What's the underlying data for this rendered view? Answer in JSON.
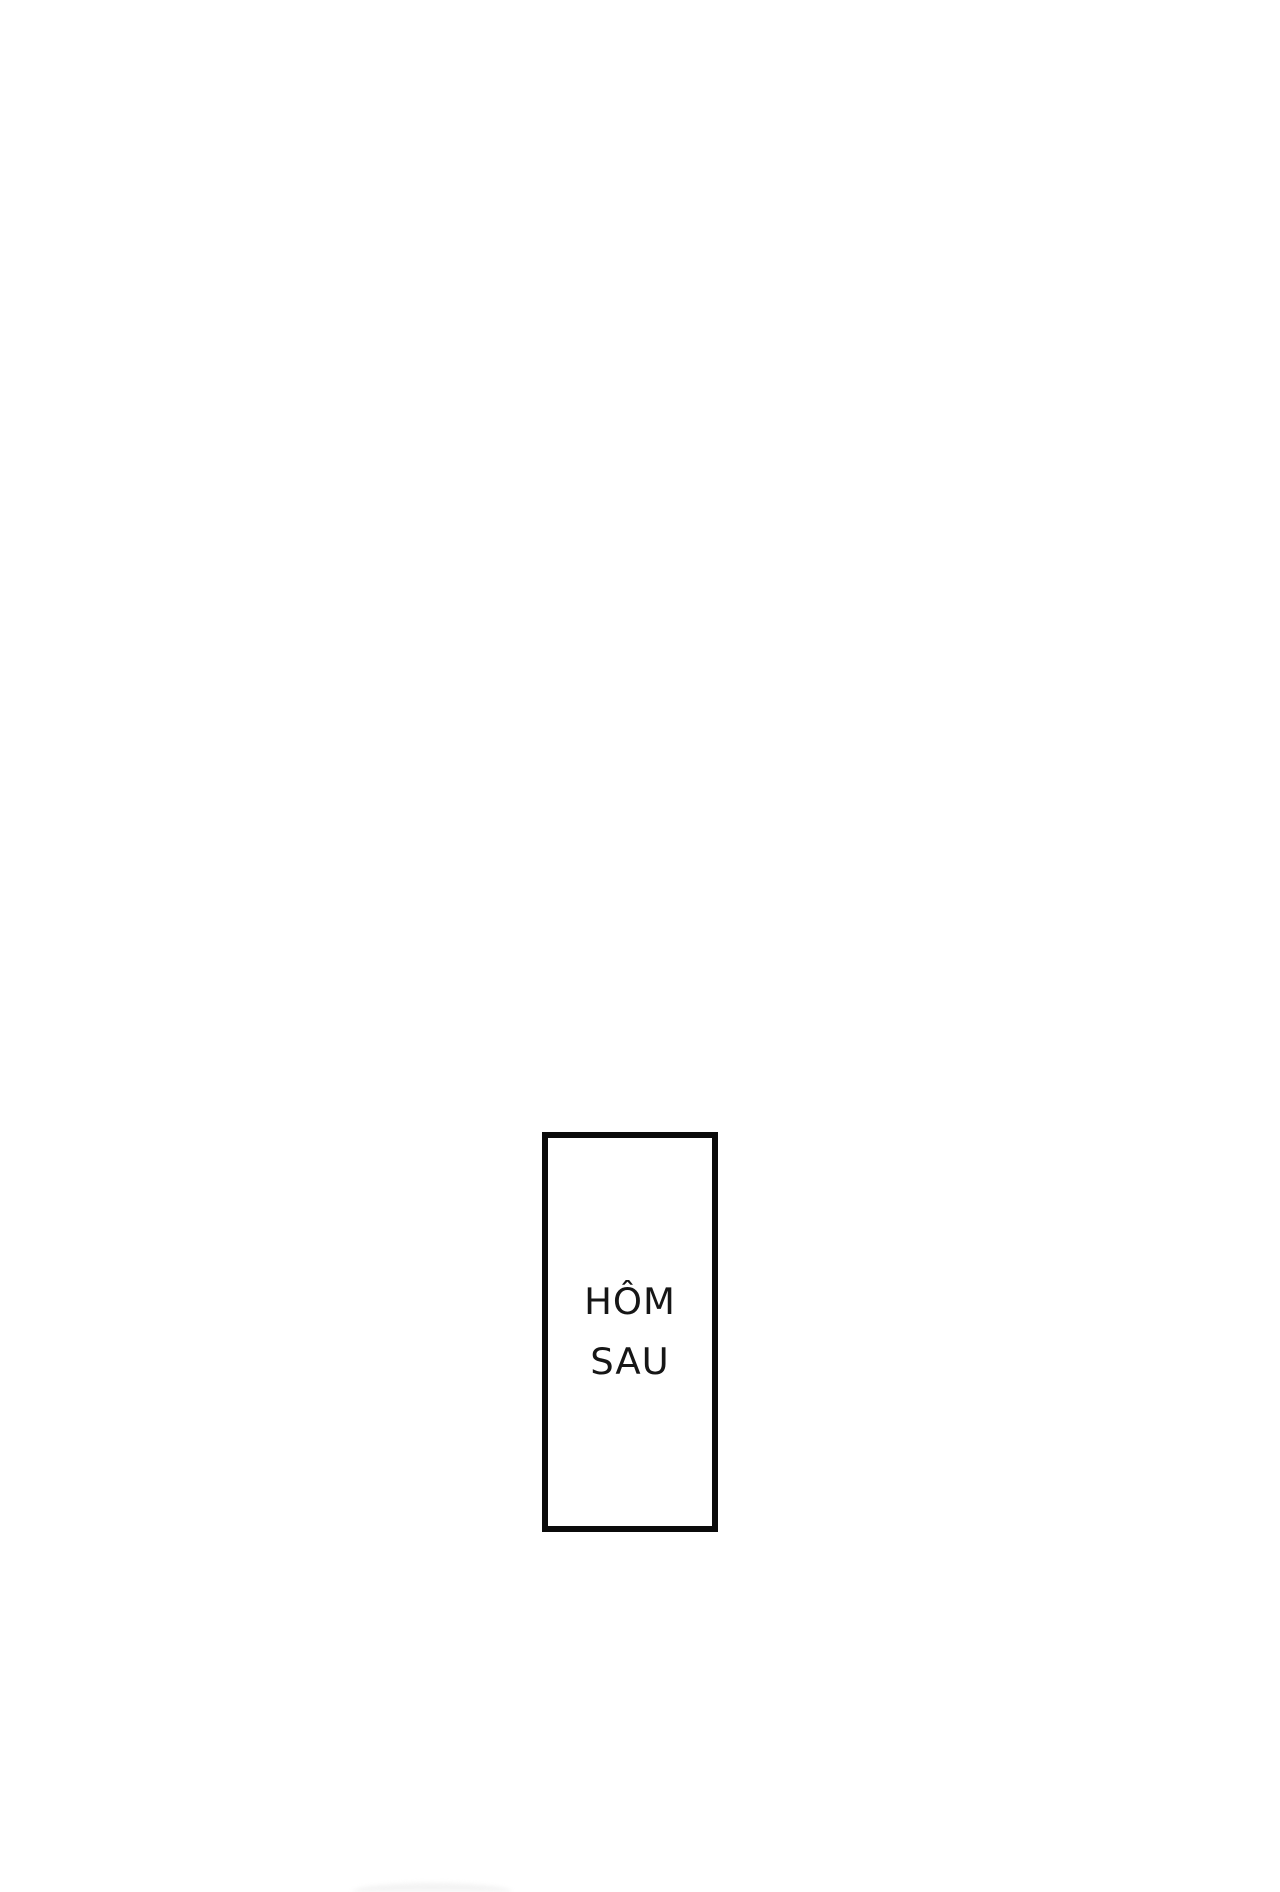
{
  "page": {
    "background_color": "#ffffff"
  },
  "panel": {
    "caption_line1": "HÔM",
    "caption_line2": "SAU",
    "border_color": "#0b0b0b",
    "text_color": "#161616"
  }
}
